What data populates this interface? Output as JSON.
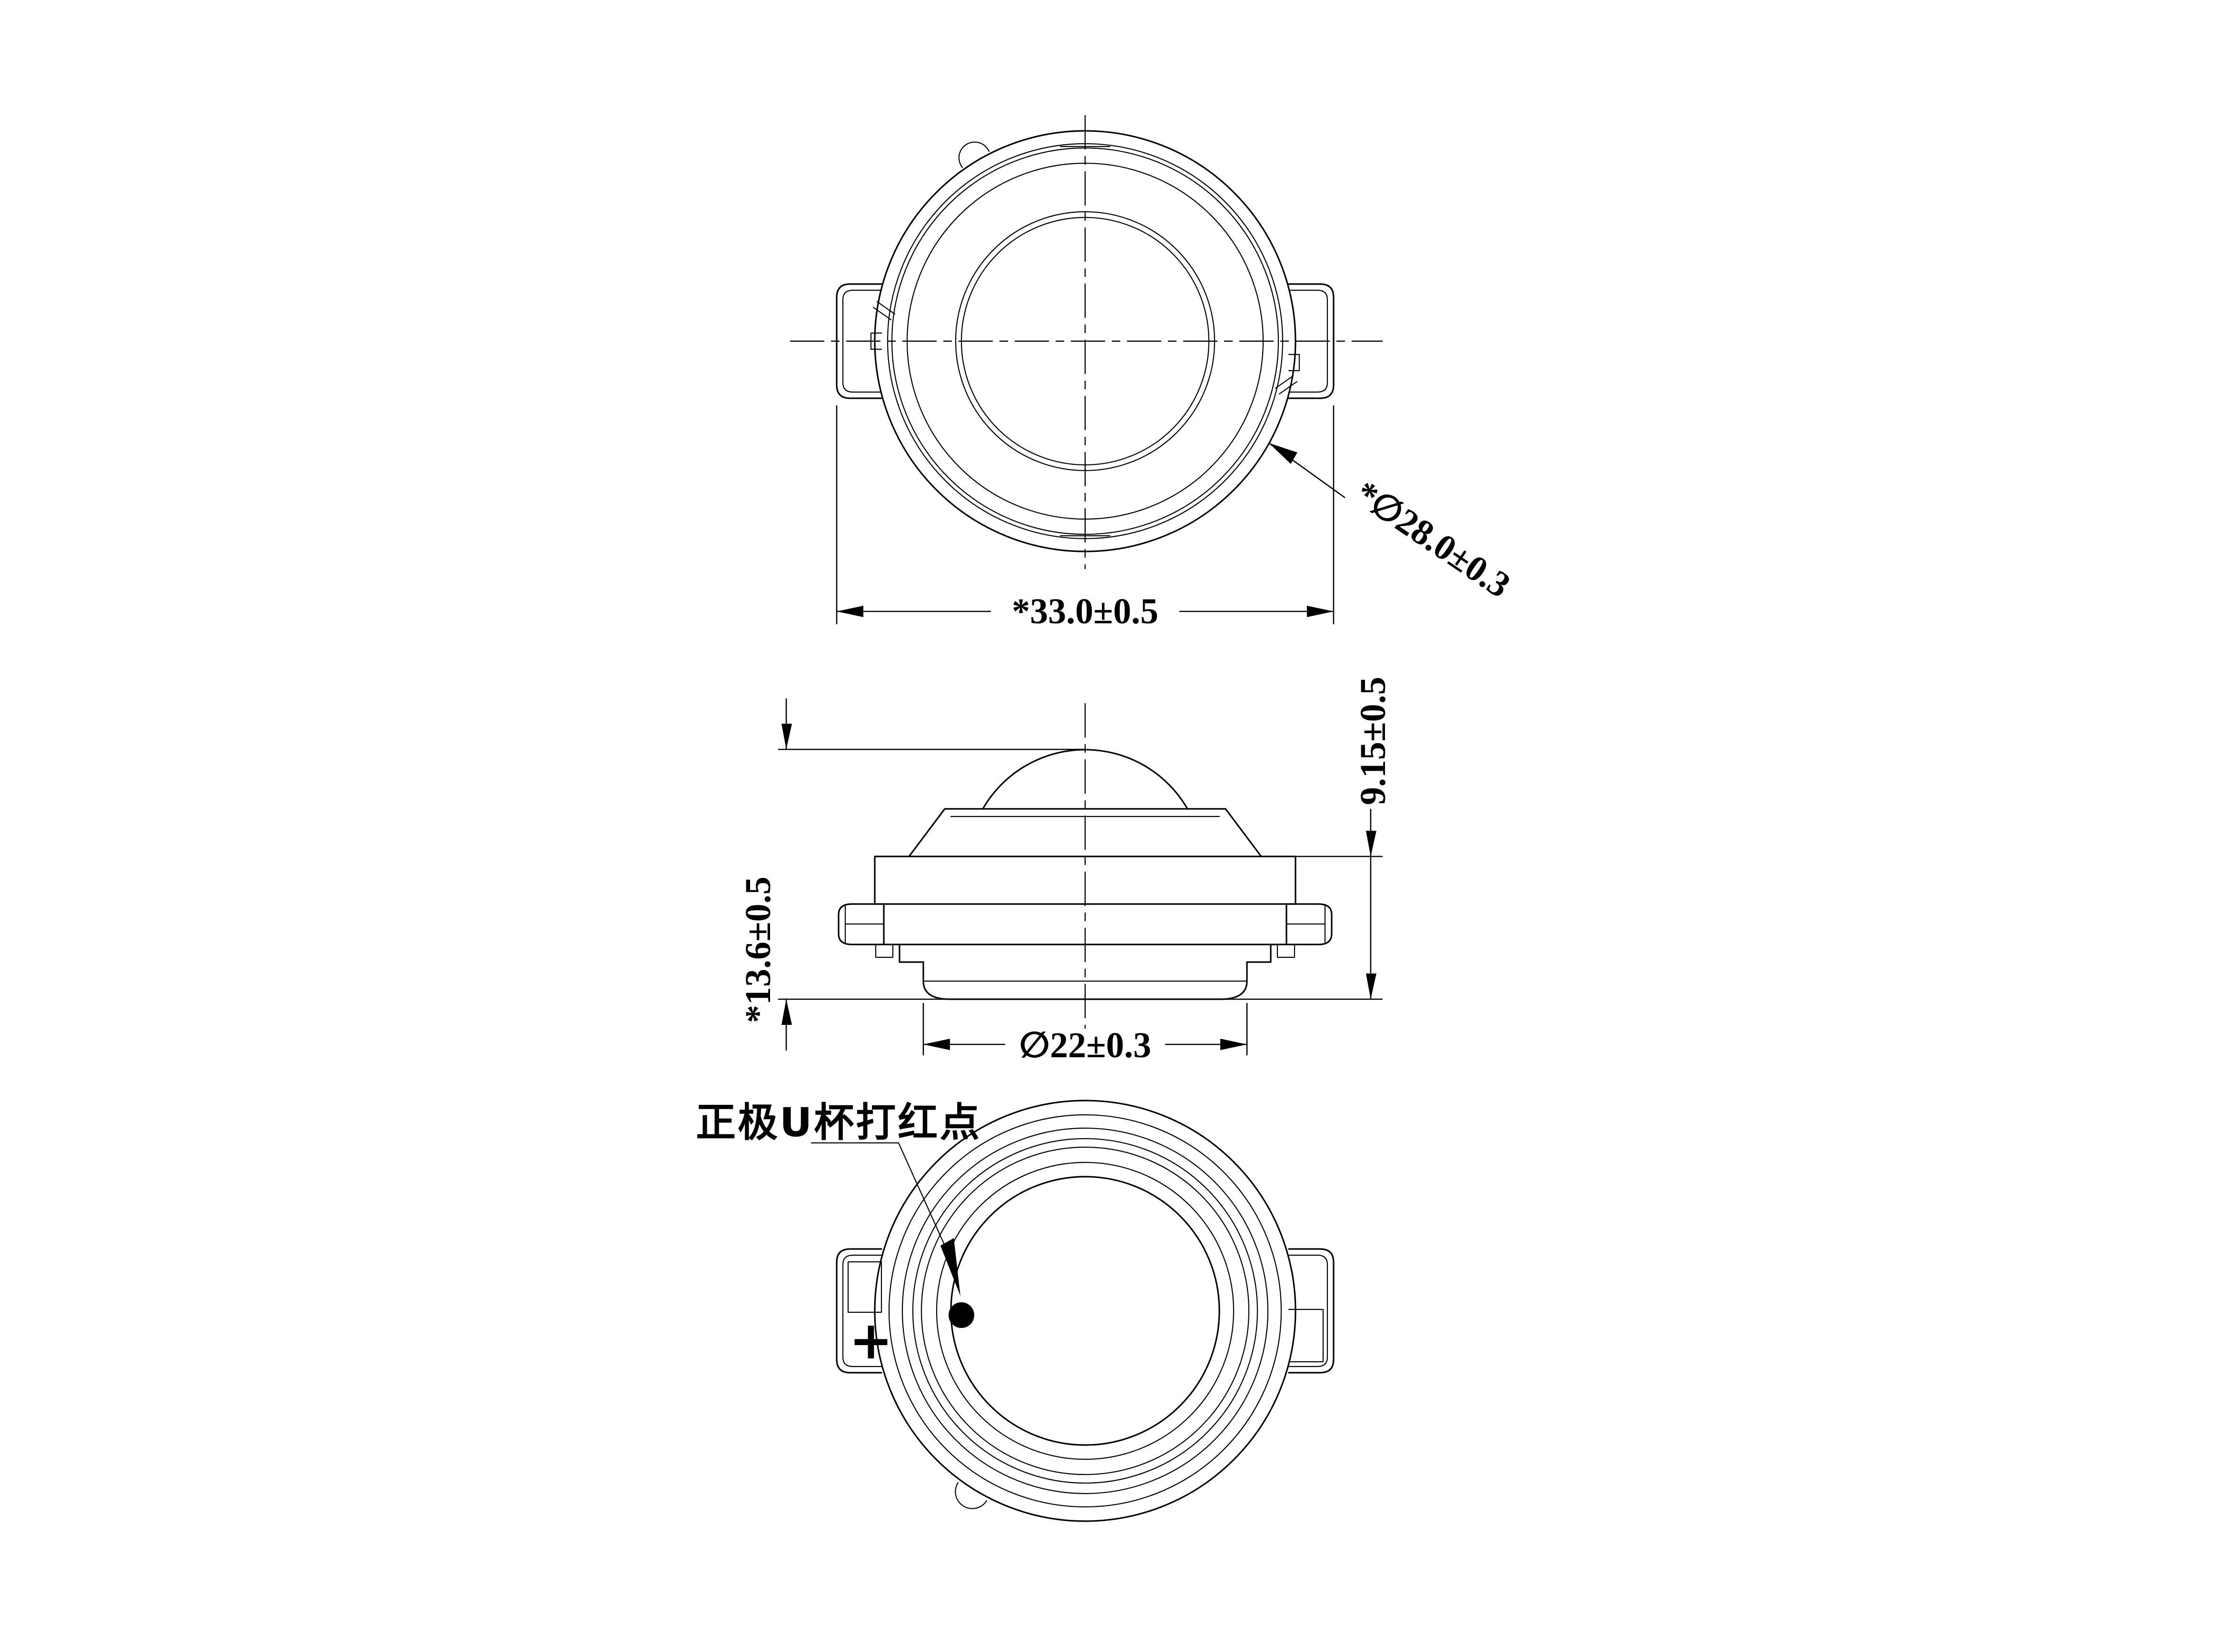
{
  "drawing": {
    "background_color": "#ffffff",
    "line_color": "#000000",
    "type": "mechanical engineering drawing, three orthographic views of a dome tweeter speaker driver",
    "annotations": {
      "top_width": "*33.0±0.5",
      "outer_diameter": "*∅28.0±0.3",
      "total_height": "*13.6±0.5",
      "body_height": "9.15±0.5",
      "cup_diameter": "∅22±0.3",
      "polarity_note": "正极U杯打红点",
      "polarity_mark": "+"
    }
  }
}
